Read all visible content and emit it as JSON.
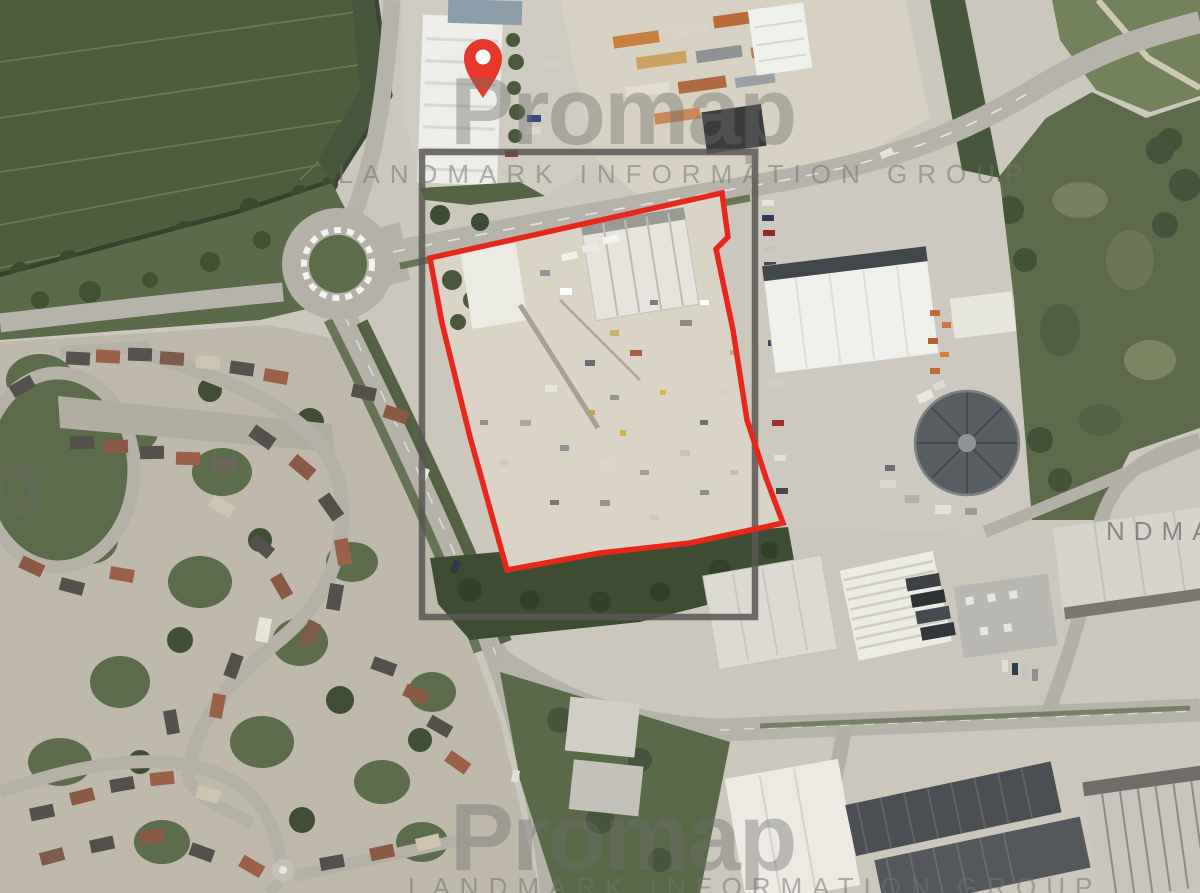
{
  "watermarks": {
    "brand": "Promap",
    "attribution": "LANDMARK INFORMATION GROUP",
    "right_edge_fragment": "NDMARK",
    "left_edge_fragment": "o"
  },
  "overlays": {
    "site_boundary": {
      "color": "#e8271c",
      "points": "430,258 722,193 728,237 716,249 733,330 747,420 766,478 783,523 690,543 600,553 507,570 470,437 442,323"
    },
    "extent_rectangle": {
      "color": "#5b5653",
      "x": "422",
      "y": "152",
      "width": "333",
      "height": "465"
    },
    "marker": {
      "color": "#e6392b"
    }
  }
}
